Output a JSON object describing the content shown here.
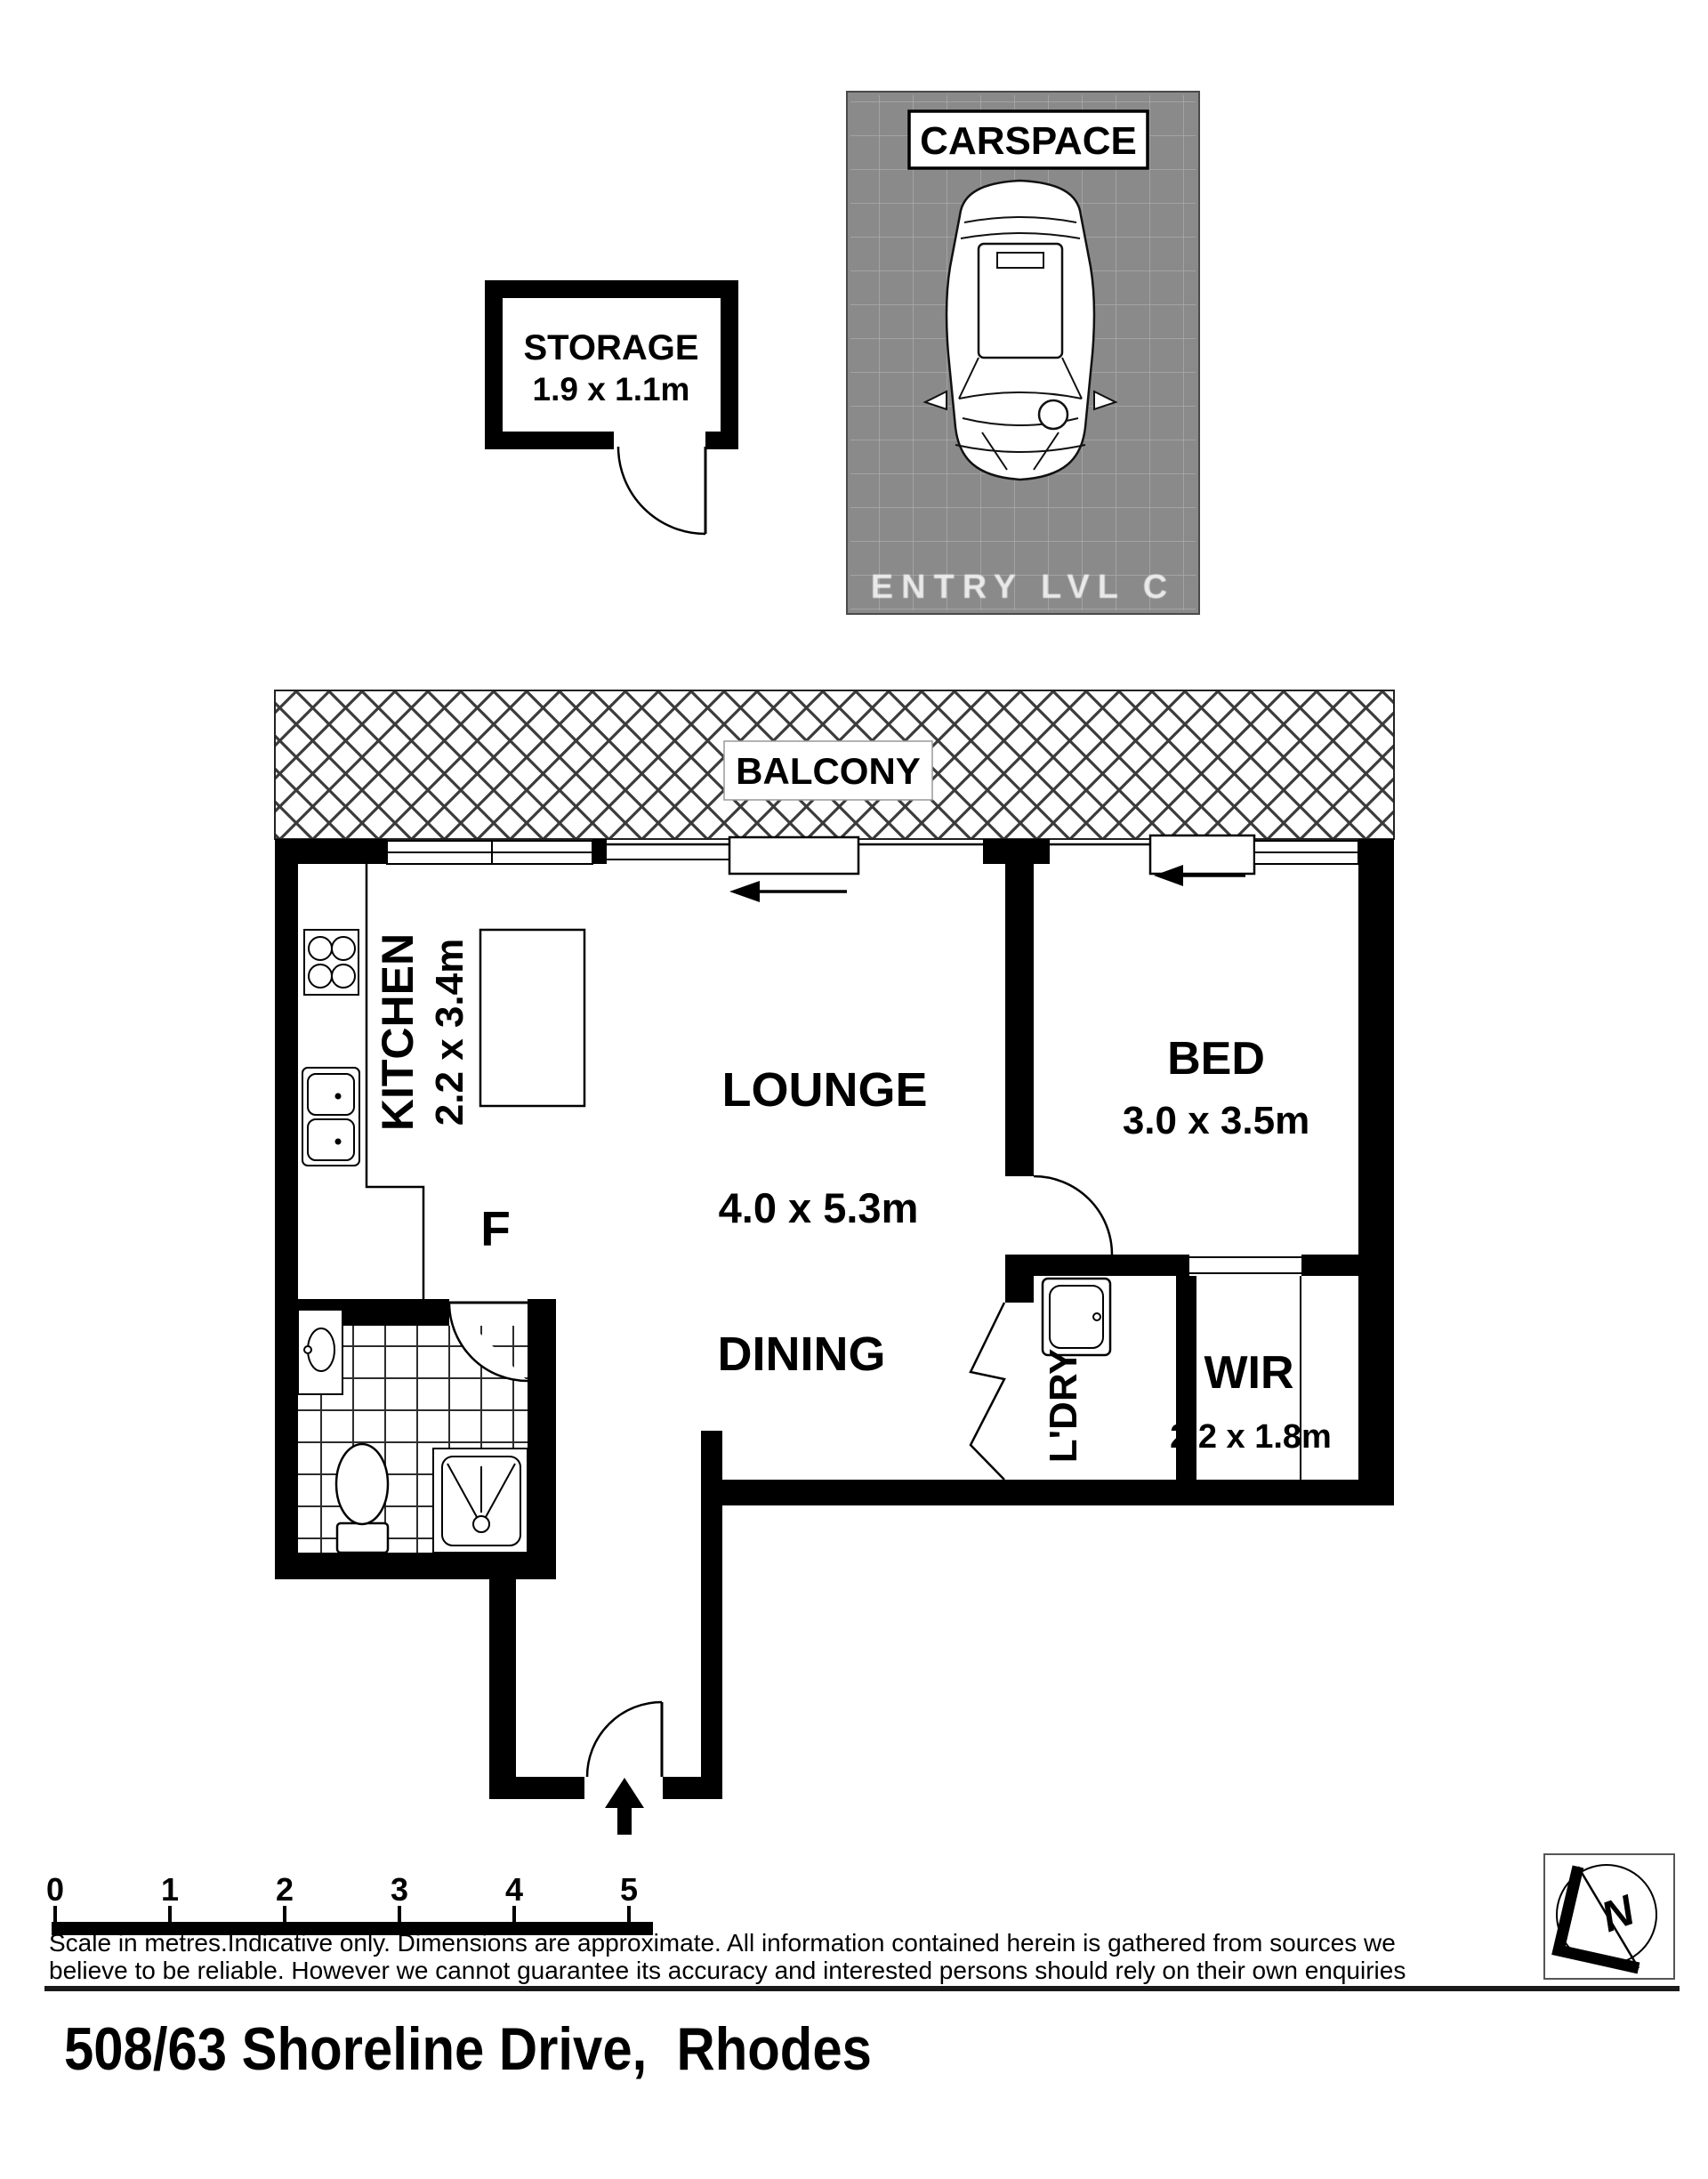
{
  "plan": {
    "carspace": {
      "label": "CARSPACE",
      "entry_text": "ENTRY LVL C"
    },
    "storage": {
      "label": "STORAGE",
      "dims": "1.9 x 1.1m"
    },
    "balcony": {
      "label": "BALCONY"
    },
    "kitchen": {
      "label": "KITCHEN",
      "dims": "2.2 x 3.4m",
      "fridge_label": "F"
    },
    "lounge": {
      "label": "LOUNGE",
      "dims": "4.0 x 5.3m"
    },
    "dining": {
      "label": "DINING"
    },
    "bed": {
      "label": "BED",
      "dims": "3.0 x 3.5m"
    },
    "laundry": {
      "label": "L'DRY"
    },
    "wir": {
      "label": "WIR",
      "dims": "2.2 x 1.8m"
    }
  },
  "scale_bar": {
    "ticks": [
      "0",
      "1",
      "2",
      "3",
      "4",
      "5"
    ]
  },
  "footer": {
    "disclaimer_line1": "Scale in metres.Indicative only. Dimensions are approximate. All information contained herein is gathered from sources we",
    "disclaimer_line2": "believe to be reliable. However we cannot guarantee its accuracy and interested persons should rely on their own enquiries",
    "address": "508/63 Shoreline Drive,  Rhodes"
  },
  "logo": {
    "letter": "N"
  },
  "colors": {
    "wall": "#000000",
    "carspace_bg": "#8a8a8a",
    "hatch": "#3b3b3b"
  }
}
